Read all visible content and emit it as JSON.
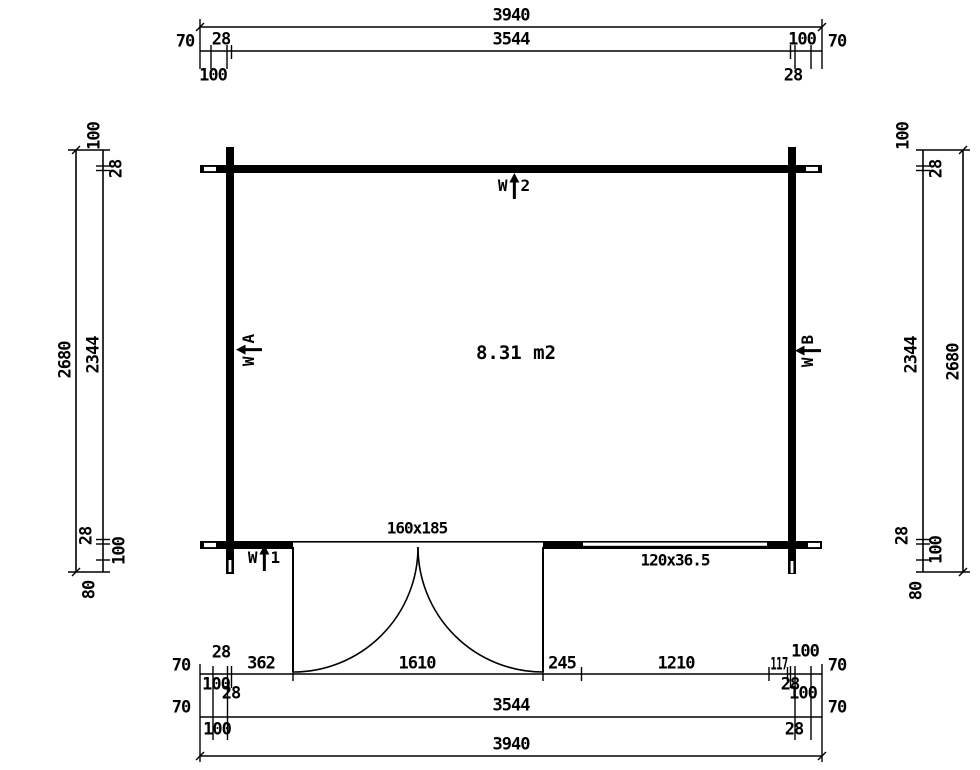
{
  "drawing": {
    "room": {
      "area_label": "8.31 m2"
    },
    "door": {
      "size_label": "160x185"
    },
    "window": {
      "size_label": "120x36.5"
    },
    "markers": {
      "w1": {
        "prefix": "W",
        "id": "1"
      },
      "w2": {
        "prefix": "W",
        "id": "2"
      },
      "wa": {
        "prefix": "W",
        "id": "A"
      },
      "wb": {
        "prefix": "W",
        "id": "B"
      }
    },
    "dims": {
      "top_overall": "3940",
      "top_row": {
        "left_outside": "70",
        "left_above": "28",
        "center": "3544",
        "right_above": "100",
        "right_outside": "70",
        "left_below": "100",
        "right_below": "28"
      },
      "bottom_row1": {
        "left_outside": "70",
        "left_above": "28",
        "seg_1": "362",
        "seg_2": "1610",
        "seg_3": "245",
        "seg_4": "1210",
        "seg_5": "117",
        "right_above": "100",
        "right_outside": "70",
        "left_below_a": "100",
        "left_below_b": "28",
        "right_below_a": "28",
        "right_below_b": "100"
      },
      "bottom_row2": {
        "left_outside": "70",
        "center": "3544",
        "right_outside": "70",
        "left_below": "100",
        "right_below": "28"
      },
      "bottom_overall": "3940",
      "left_col": {
        "outer": "2680",
        "top_overhang": "100",
        "top_wall": "28",
        "interior": "2344",
        "bottom_wall": "28",
        "bottom_overhang": "100",
        "base": "80"
      },
      "right_col": {
        "outer": "2680",
        "top_overhang": "100",
        "top_wall": "28",
        "interior": "2344",
        "bottom_wall": "28",
        "bottom_overhang": "100",
        "base": "80"
      }
    }
  }
}
